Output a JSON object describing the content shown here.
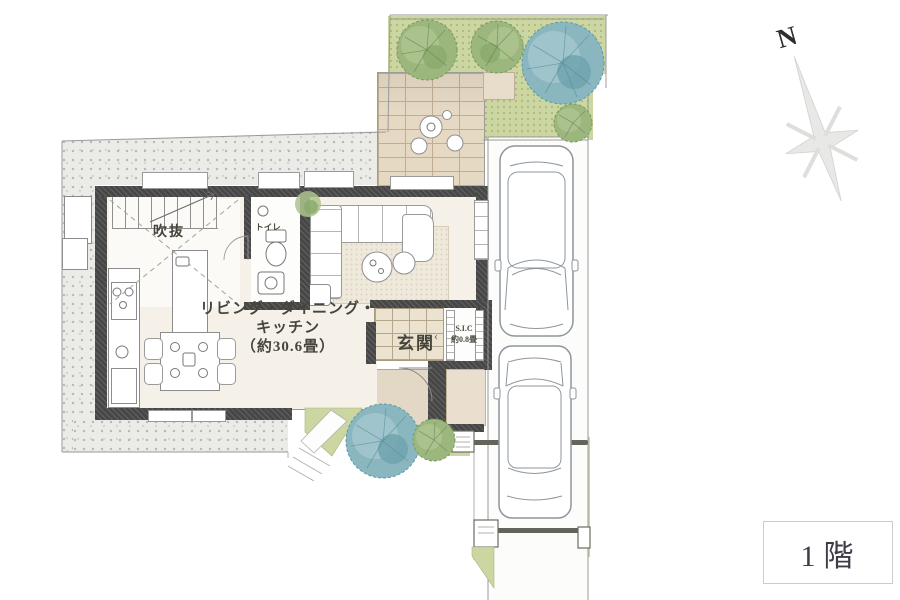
{
  "plan": {
    "labels": {
      "ldk": {
        "line1": "リビング・ダイニング・",
        "line2": "キッチン",
        "line3": "（約30.6畳）"
      },
      "genkan": "玄関",
      "sic": "S.I.C",
      "sic_size": "約0.8畳",
      "sic_arrow": "‹",
      "toilet": "トイレ",
      "atrium": "吹抜"
    },
    "compass": "N",
    "floor_badge": "1階"
  },
  "palette": {
    "wall": "#474747",
    "floor": "#f6f1e8",
    "lawn": "#ccd6a0",
    "brick": "#e6d9c4",
    "brickline": "#c0ad92",
    "abrick": "#d8c6a9",
    "tile": "#ebe2cf",
    "tileline": "#b4a68a",
    "ink": "#45453c",
    "carline": "#8e959d",
    "gate": "#64645c",
    "badgeink": "#3d3d47",
    "badgeborder": "#cccccc",
    "teal_tree": "#8ab6bf",
    "green_tree": "#9cb77e"
  }
}
